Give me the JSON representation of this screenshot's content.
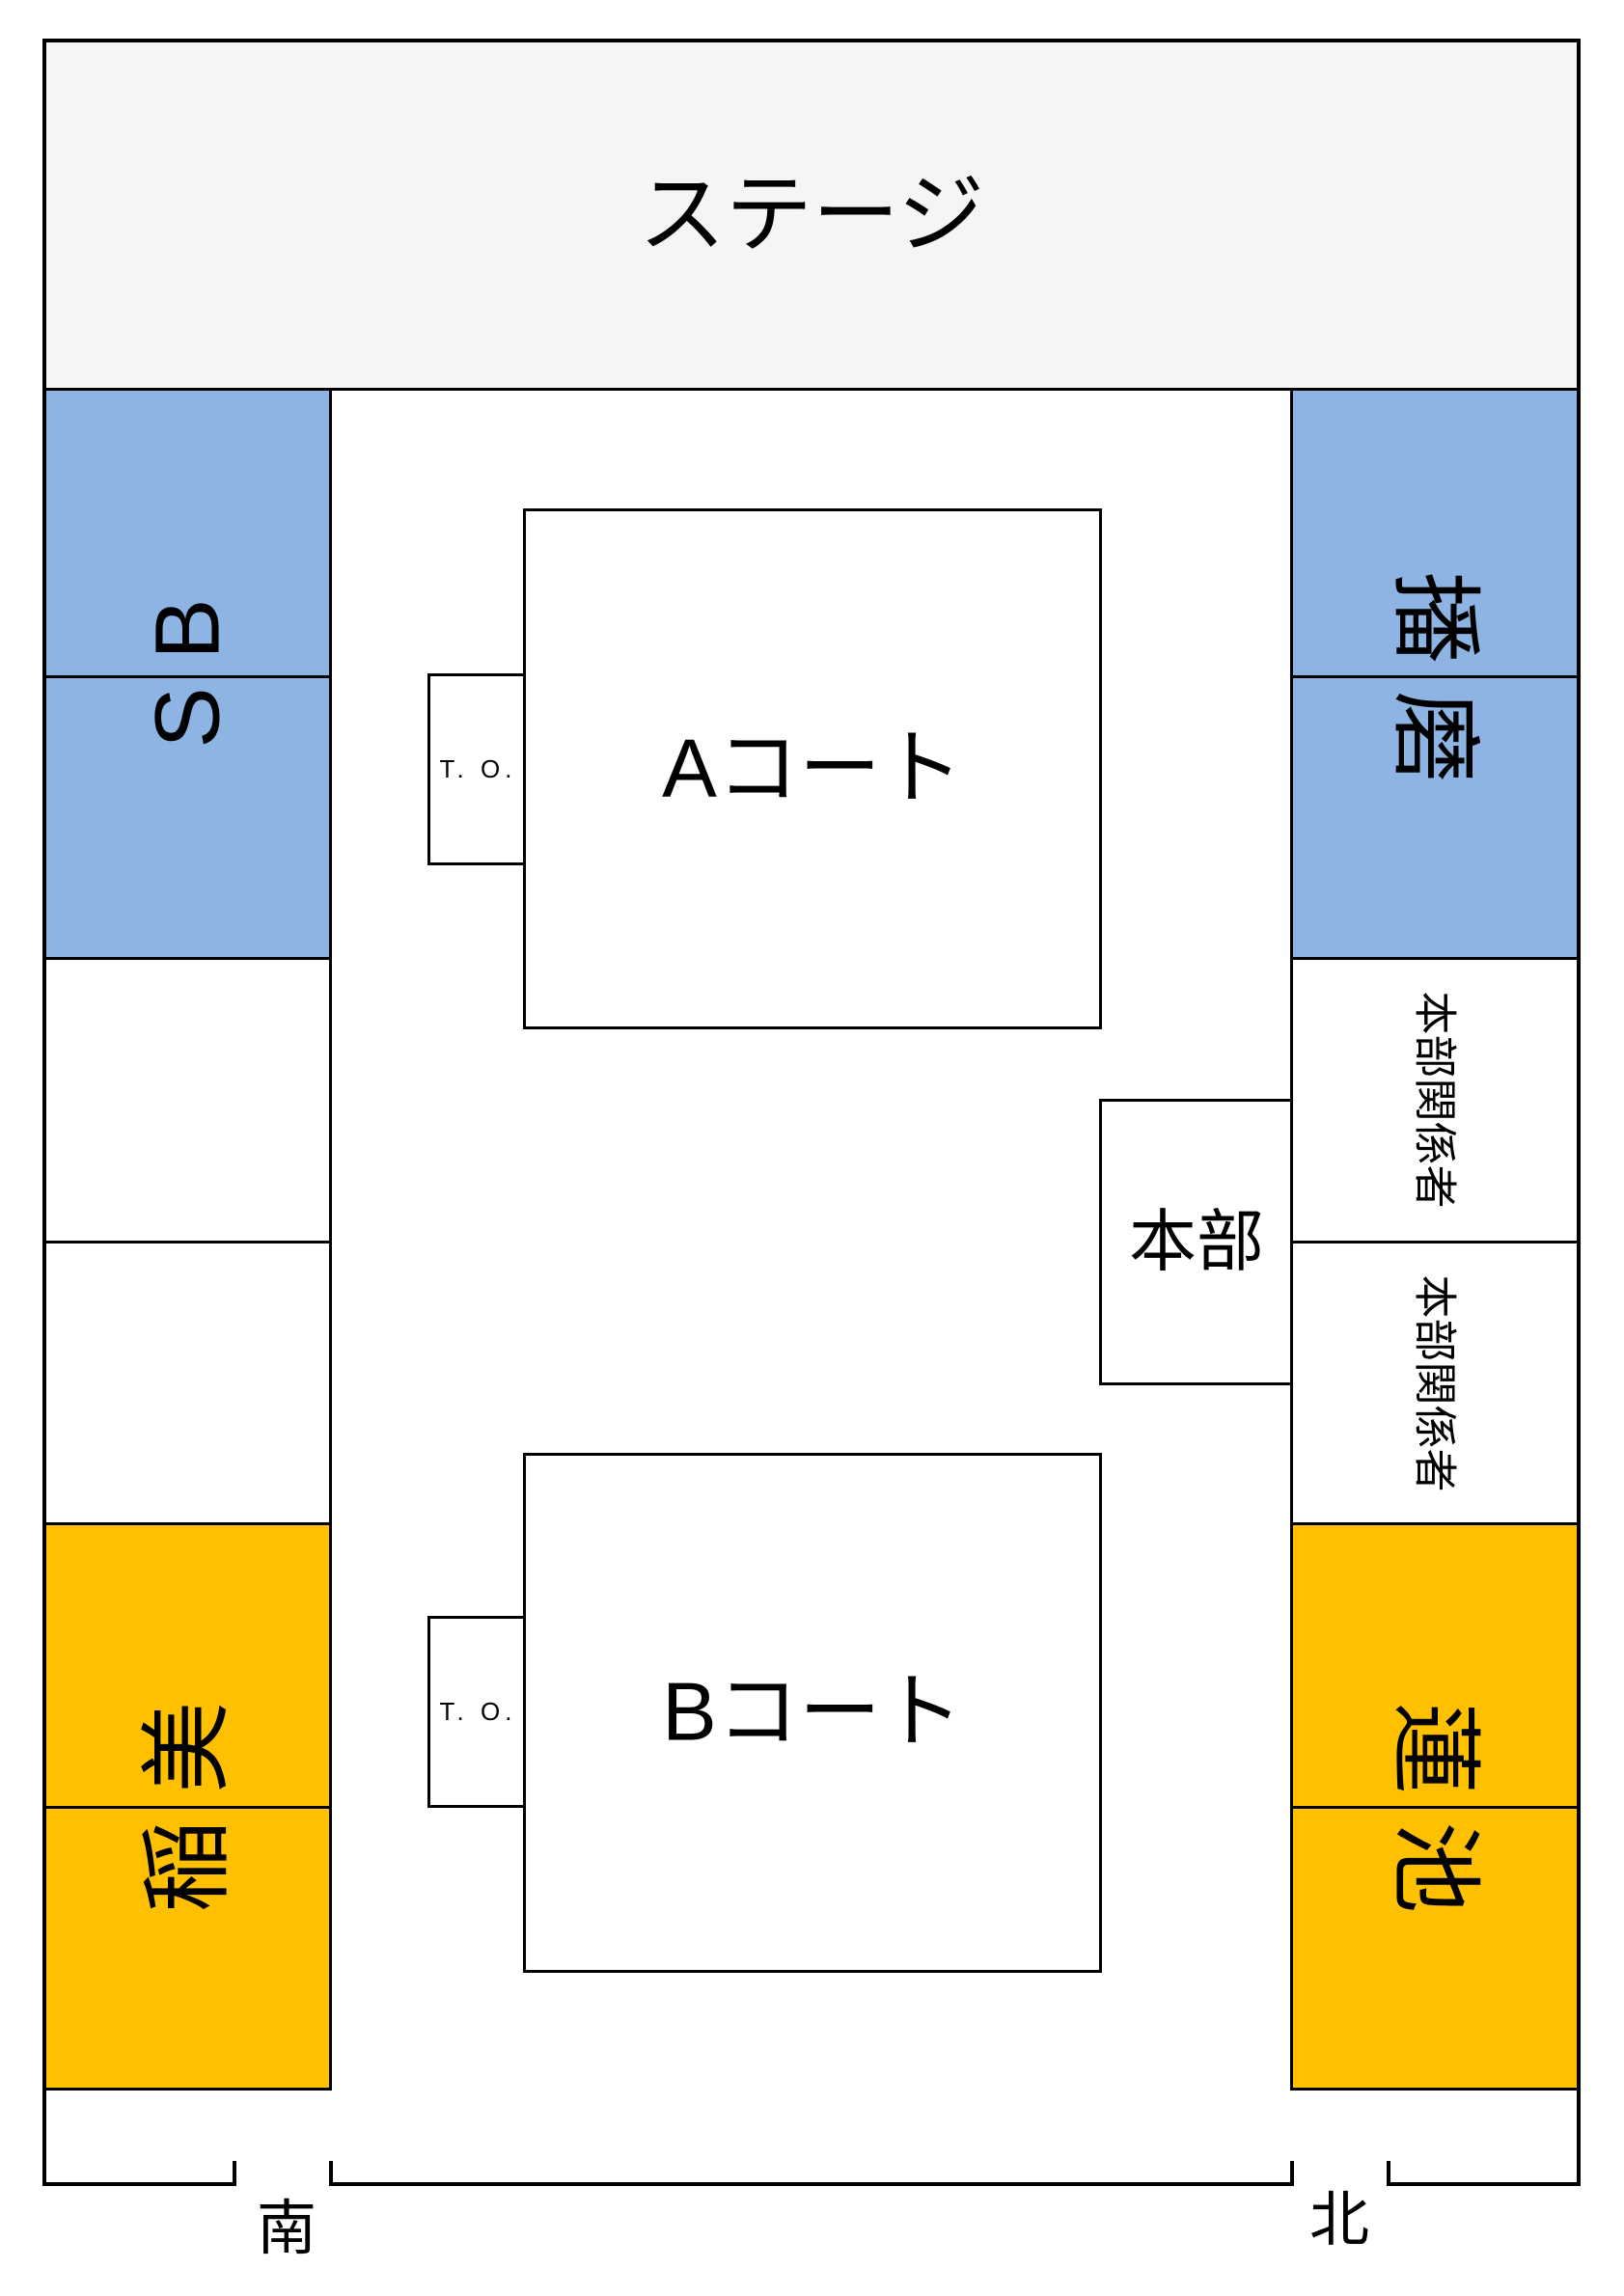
{
  "colors": {
    "stage_fill": "#F5F5F5",
    "seat_blue": "#8DB4E2",
    "seat_orange": "#FFC000",
    "line_black": "#000000"
  },
  "stage": {
    "label": "ステージ"
  },
  "court_a": {
    "label": "Aコート",
    "table_officials": "T. O."
  },
  "court_b": {
    "label": "Bコート",
    "table_officials": "T. O."
  },
  "headquarters": {
    "label": "本部"
  },
  "seating": {
    "left_blue_label": "SB",
    "left_orange_label": "稲美",
    "right_blue_label": "播磨",
    "right_orange_label": "蓮池",
    "right_staff_label_1": "本部関係者",
    "right_staff_label_2": "本部関係者"
  },
  "directions": {
    "south_label": "南",
    "north_label": "北"
  }
}
